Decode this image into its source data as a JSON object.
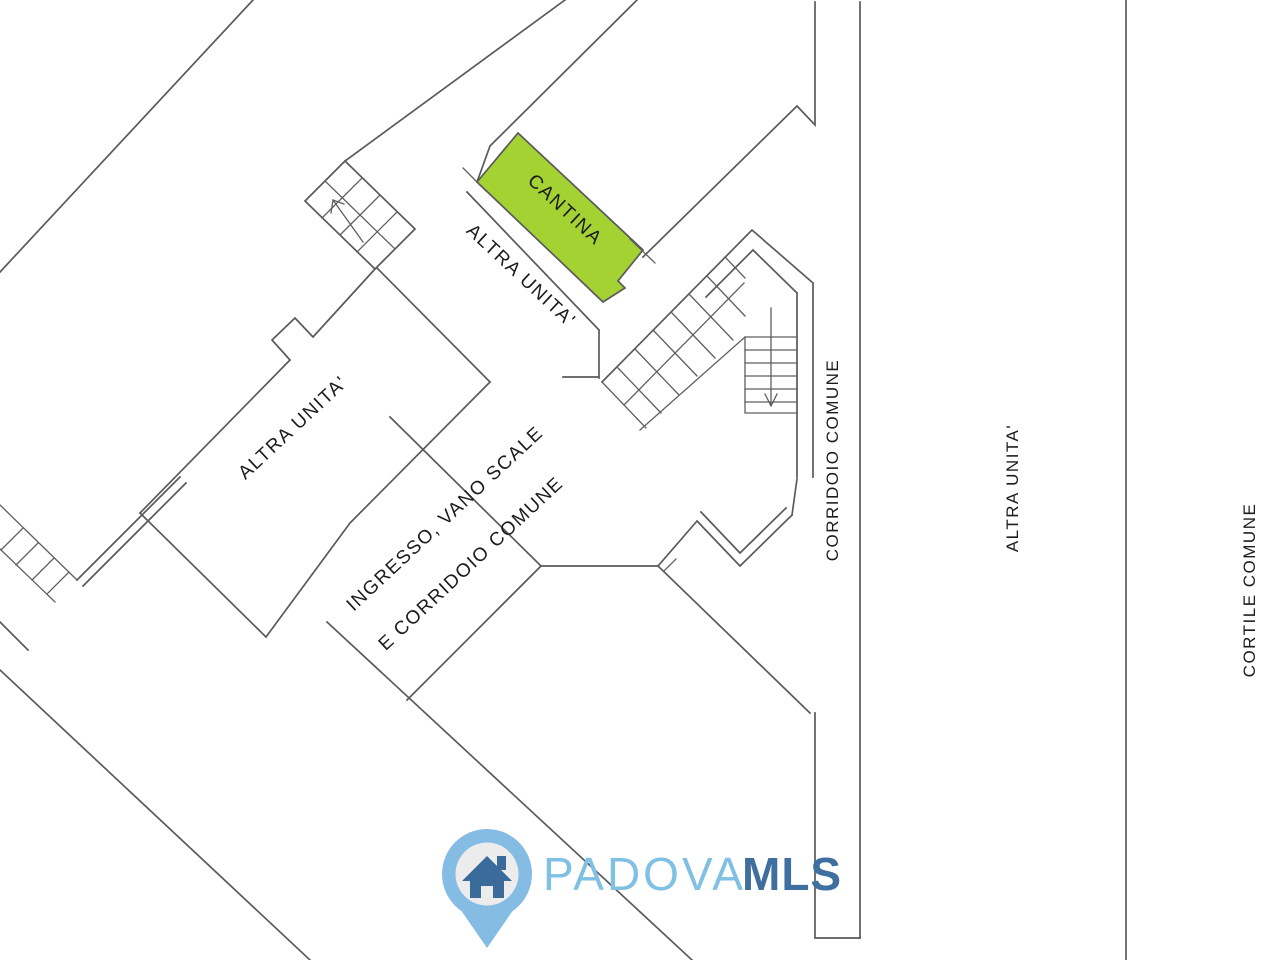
{
  "plan": {
    "rooms": {
      "cantina": "CANTINA",
      "altra_unita_band": "ALTRA UNITA'",
      "altra_unita_main": "ALTRA UNITA'",
      "ingresso_line1": "INGRESSO, VANO SCALE",
      "ingresso_line2": "E CORRIDOIO COMUNE",
      "corridoio_comune": "CORRIDOIO COMUNE",
      "altra_unita_right": "ALTRA UNITA'",
      "cortile_comune": "CORTILE COMUNE"
    },
    "highlight_color": "#a3d232",
    "wall_color": "#5a5a5a",
    "text_color": "#1c1c1c"
  },
  "logo": {
    "brand_primary": "PADOVA",
    "brand_secondary": "MLS",
    "primary_color": "#7fc0e4",
    "secondary_color": "#3f6f9e",
    "pin_color": "#84bce3",
    "pin_inner_color": "#ececec",
    "house_color": "#3a6b9b"
  }
}
